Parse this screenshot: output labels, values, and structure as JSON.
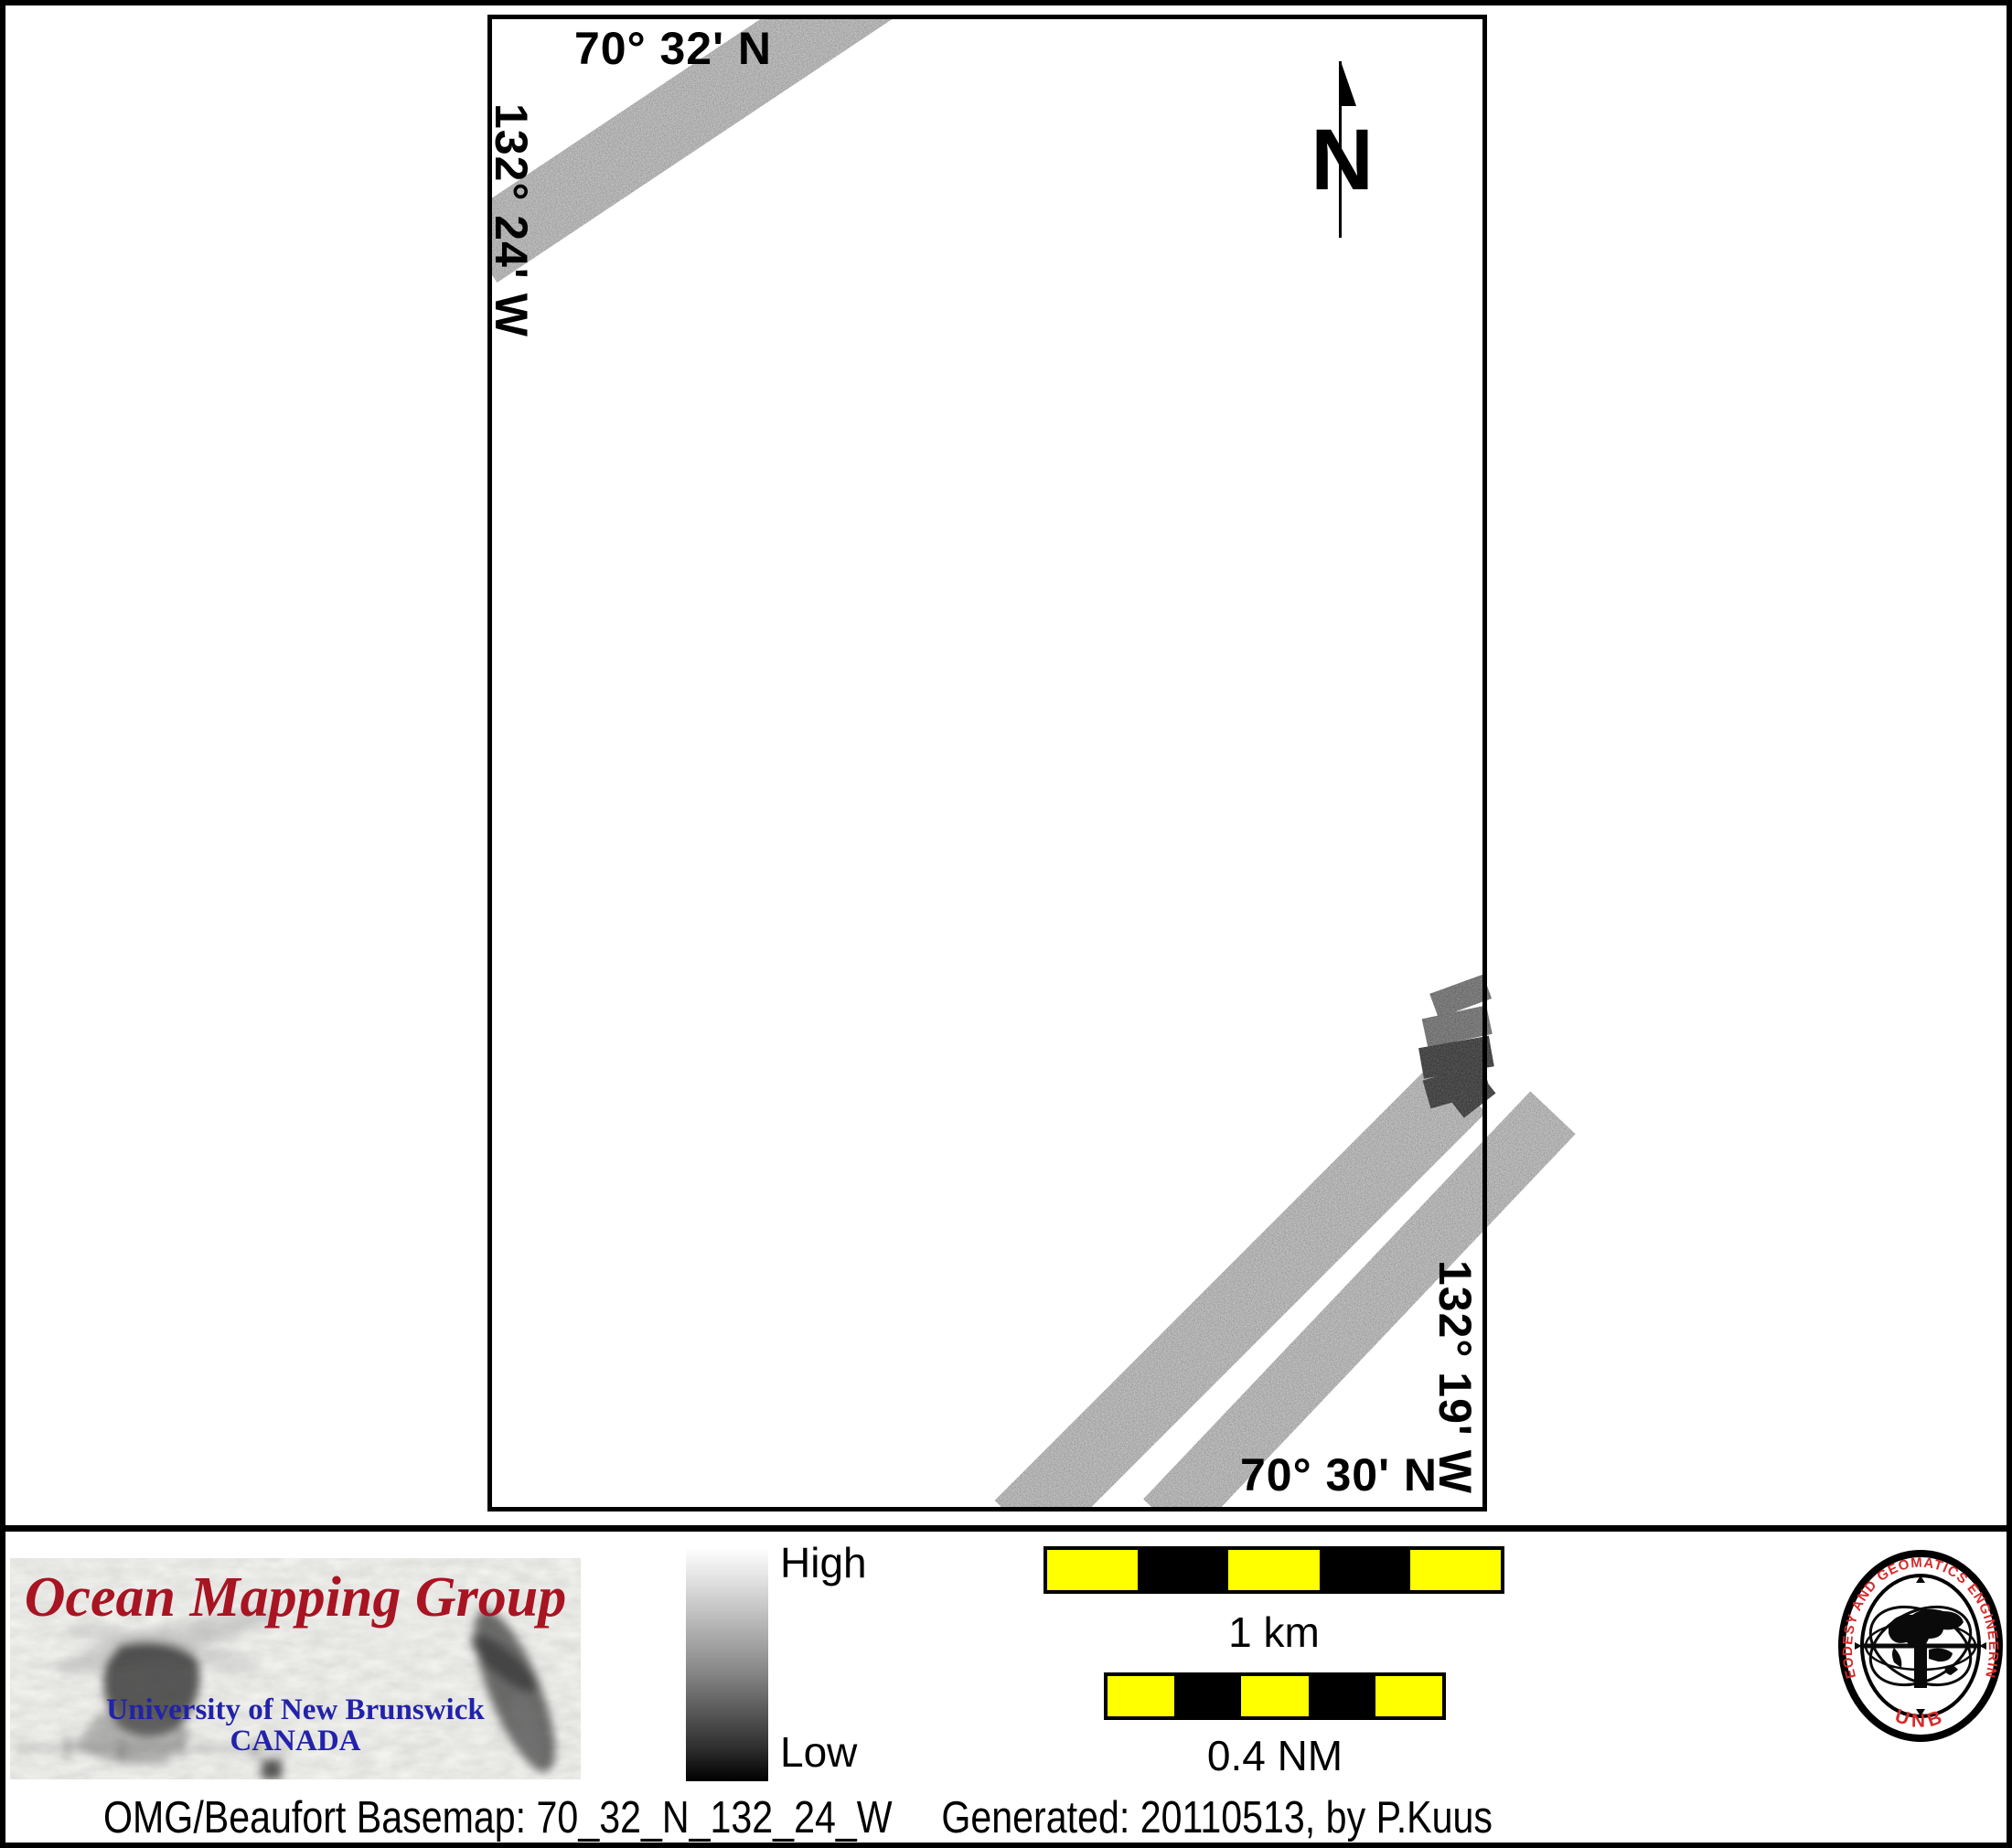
{
  "map": {
    "label_top": "70° 32' N",
    "label_left": "132° 24' W",
    "label_right": "132° 19' W",
    "label_bottom": "70° 30' N",
    "north_label": "N"
  },
  "legend": {
    "high": "High",
    "low": "Low"
  },
  "scalebars": {
    "km_label": "1 km",
    "nm_label": "0.4 NM",
    "segment_colors": [
      "#ffff00",
      "#000000",
      "#ffff00",
      "#000000",
      "#ffff00"
    ]
  },
  "caption": {
    "basemap": "OMG/Beaufort Basemap: 70_32_N_132_24_W",
    "generated": "Generated: 20110513, by P.Kuus"
  },
  "omg_logo": {
    "title": "Ocean Mapping Group",
    "university": "University of New Brunswick",
    "country": "CANADA"
  },
  "unb_seal": {
    "arc_text": "GEODESY AND GEOMATICS ENGINEERING",
    "bottom_text": "UNB"
  },
  "colors": {
    "scalebar_yellow": "#ffff00",
    "omg_title_red": "#a81422",
    "omg_blue": "#2222aa",
    "seal_red": "#d62b2b",
    "frame_black": "#000000"
  }
}
